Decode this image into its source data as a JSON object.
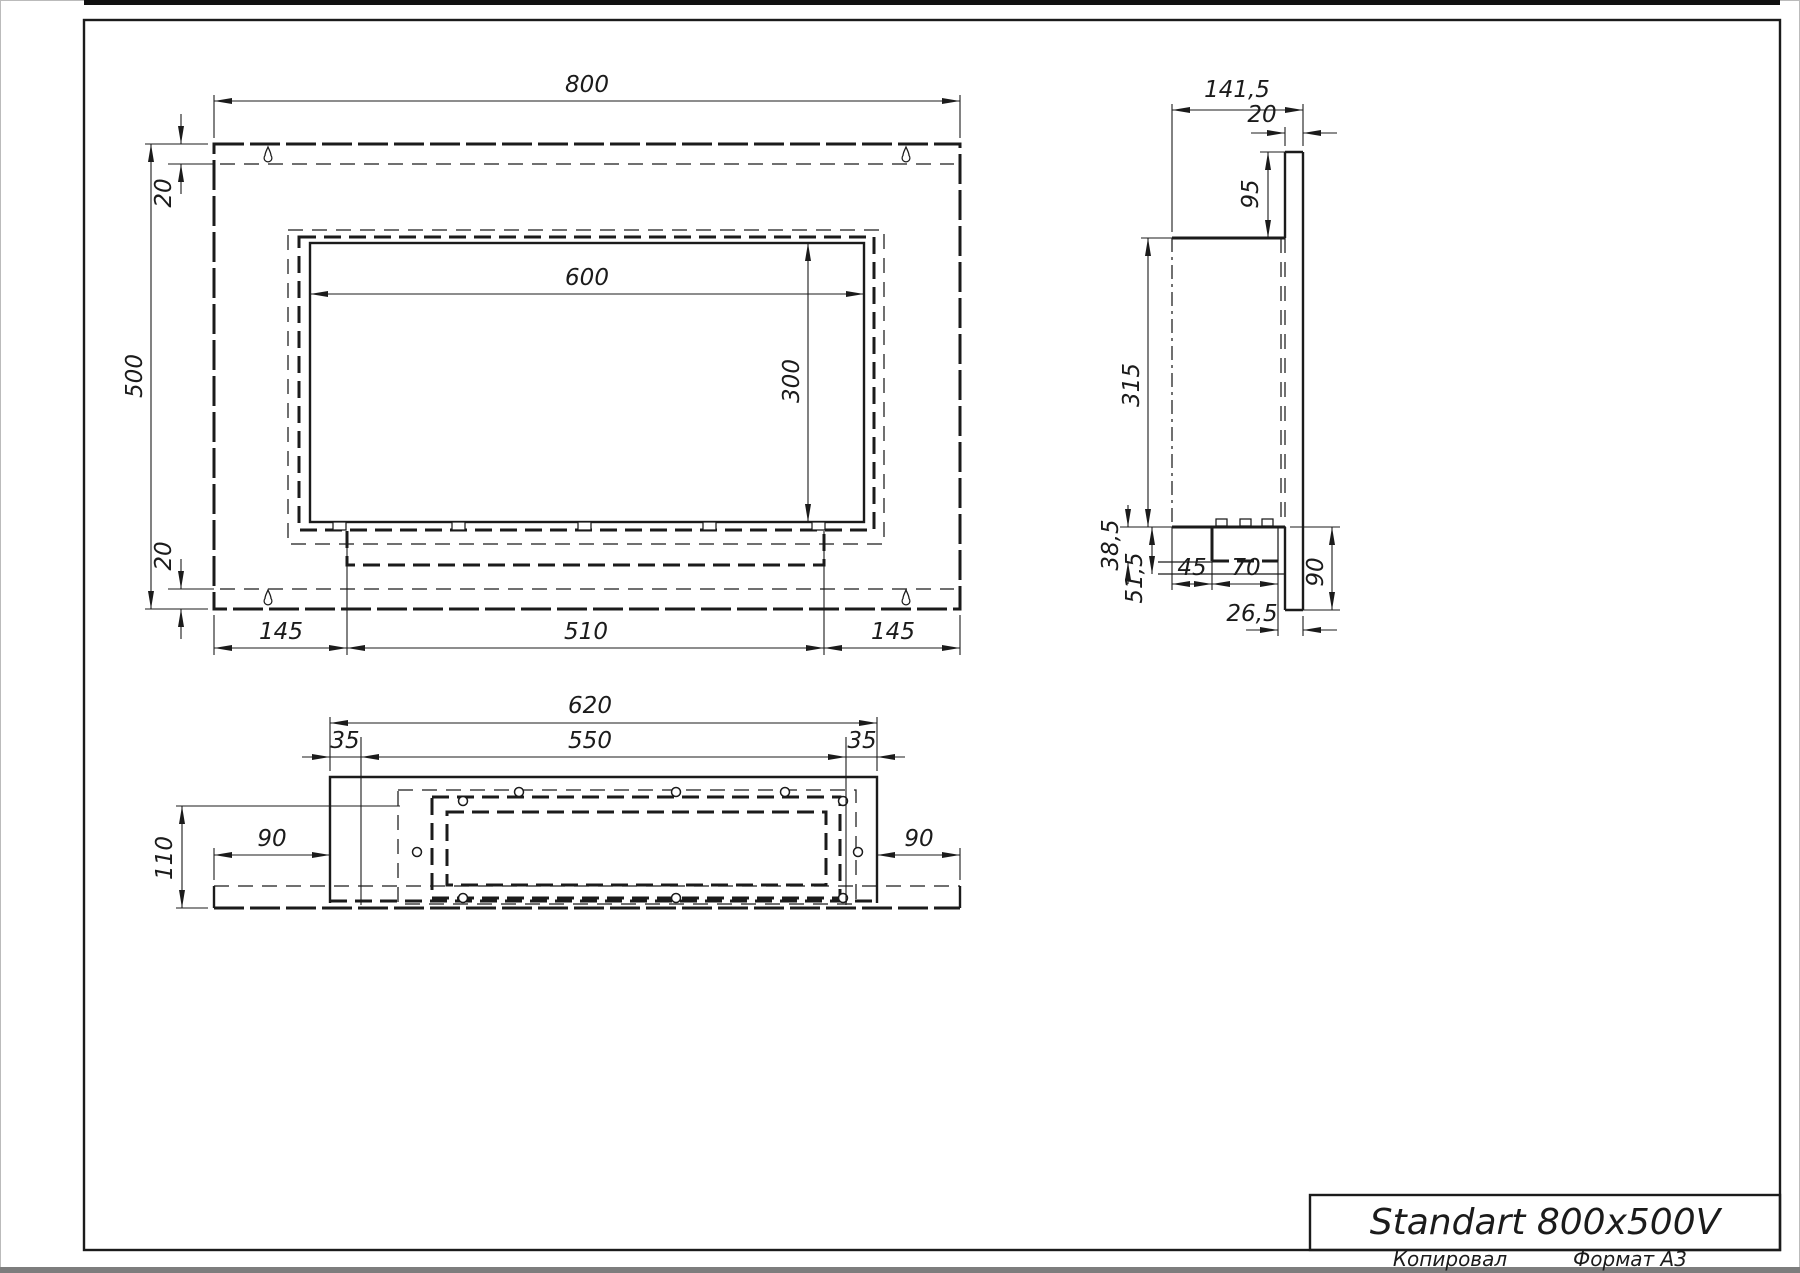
{
  "front_view": {
    "dim_width": "800",
    "dim_height": "500",
    "dim_top_offset": "20",
    "dim_bottom_offset": "20",
    "dim_opening_width": "600",
    "dim_opening_height": "300",
    "dim_margin_left": "145",
    "dim_tray_width": "510",
    "dim_margin_right": "145"
  },
  "side_view": {
    "dim_depth": "141,5",
    "dim_plate_thickness": "20",
    "dim_plate_top_extension": "95",
    "dim_body_height": "315",
    "dim_lip_height": "38,5",
    "dim_bottom_offset": "51,5",
    "dim_burner_inset": "45",
    "dim_burner_width": "70",
    "dim_plate_bottom_extension": "90",
    "dim_burner_to_plate_edge": "26,5"
  },
  "bottom_view": {
    "dim_body_width": "620",
    "dim_inset_left": "35",
    "dim_opening_width": "550",
    "dim_inset_right": "35",
    "dim_depth": "110",
    "dim_flange_left": "90",
    "dim_flange_right": "90"
  },
  "title_block": {
    "title": "Standart 800x500V"
  },
  "footer": {
    "copied_label": "Копировал",
    "format_label": "Формат A3"
  }
}
